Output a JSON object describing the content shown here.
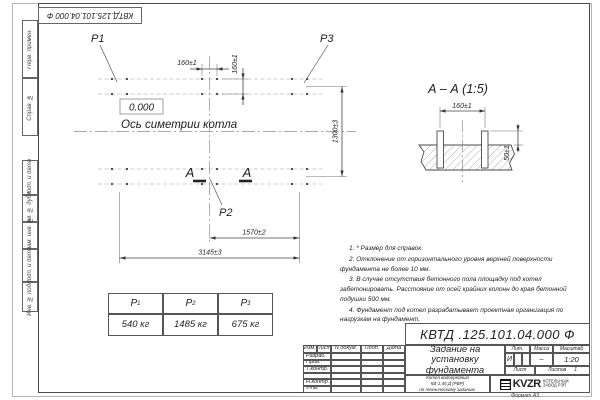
{
  "stamp": {
    "doc_number": "КВТД.125.101.04.000  Ф"
  },
  "margin": {
    "labels": [
      "Перв. примен.",
      "Справ. №",
      "Подп. и дата",
      "Инв. № дубл.",
      "Взам. инв. №",
      "Подп. и дата",
      "Инв. № подл."
    ]
  },
  "plan": {
    "p1": "P1",
    "p2": "P2",
    "p3": "P3",
    "level": "0.000",
    "axis": "Ось симетрии котла",
    "section_letter_left": "А",
    "section_letter_right": "А",
    "dim_bolt_h": "160±1",
    "dim_bolt_v": "160±1",
    "dim_rows": "1300±3",
    "dim_mid": "1570±2",
    "dim_overall": "3145±3"
  },
  "section": {
    "title": "А – А (1:5)",
    "dim_spacing": "160±1",
    "dim_height": "50±1"
  },
  "notes": [
    "1. * Размер для справок.",
    "2. Отклонение от горизонтального уровня верхней поверхности фундамента не более 10 мм.",
    "3. В случае отсутствия бетонного пола площадку под котел забетонировать. Расстояние от осей крайних колонн до края бетонной подушки 500 мм.",
    "4. Фундамент под котел разрабатывает проектная организация по нагрузкам на фундамент."
  ],
  "load_table": {
    "headers": [
      {
        "p": "P",
        "sub": "1"
      },
      {
        "p": "P",
        "sub": "2"
      },
      {
        "p": "P",
        "sub": "3"
      }
    ],
    "values": [
      "540 кг",
      "1485 кг",
      "675 кг"
    ]
  },
  "title_block": {
    "doc_number": "КВТД .125.101.04.000  Ф",
    "columns": [
      "Изм.",
      "Лист",
      "N докум.",
      "Подп.",
      "Дата"
    ],
    "rows": [
      "Разраб.",
      "Пров.",
      "Т.контр.",
      "",
      "Н.контр.",
      "Утв."
    ],
    "title_lines": [
      "Задание на",
      "установку",
      "фундамента"
    ],
    "subtitle_lines": [
      "Котел водогрейный",
      "КВ-1,45 Д (РВР)",
      "по техническому заданию"
    ],
    "lit_label": "Лит.",
    "mass_label": "Масса",
    "scale_label": "Масштаб",
    "lit_value": "И",
    "mass_value": "–",
    "scale_value": "1:20",
    "sheet_label": "Лист",
    "sheets_label": "Листов",
    "sheets_value": "1",
    "logo_text": "KVZR",
    "company_lines": [
      "КОТЕЛЬНЫЙ",
      "ЗАВОД РЭП"
    ],
    "format": "Формат А3"
  }
}
